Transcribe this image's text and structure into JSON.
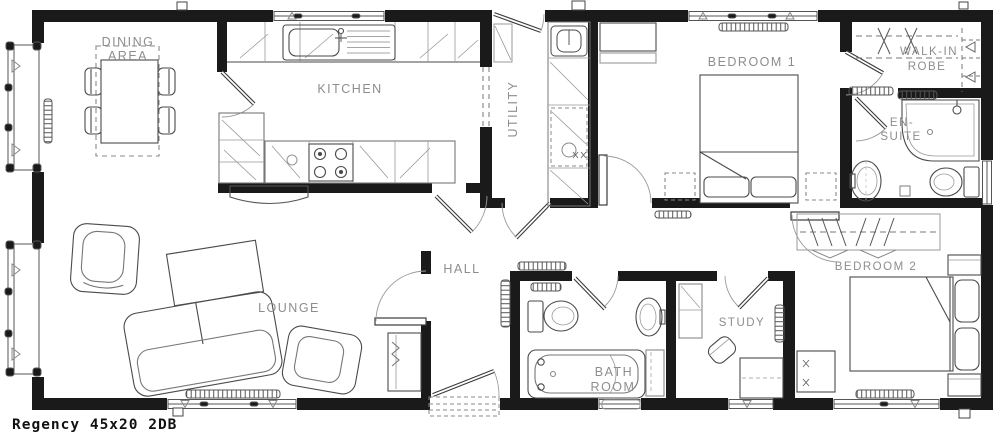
{
  "plan": {
    "model_label": "Regency 45x20 2DB"
  },
  "rooms": {
    "dining": {
      "line1": "DINING",
      "line2": "AREA"
    },
    "kitchen": {
      "label": "KITCHEN"
    },
    "utility": {
      "label": "UTILITY"
    },
    "bedroom1": {
      "label": "BEDROOM 1"
    },
    "robe": {
      "line1": "WALK-IN",
      "line2": "ROBE"
    },
    "ensuite": {
      "line1": "EN-",
      "line2": "SUITE"
    },
    "lounge": {
      "label": "LOUNGE"
    },
    "hall": {
      "label": "HALL"
    },
    "bathroom": {
      "line1": "BATH",
      "line2": "ROOM"
    },
    "study": {
      "label": "STUDY"
    },
    "bedroom2": {
      "label": "BEDROOM 2"
    }
  },
  "colors": {
    "wall": "#1a1a1a",
    "label": "#8d8d8d",
    "furniture_line": "#4a4a4a",
    "light_line": "#9a9a9a",
    "background": "#ffffff"
  }
}
